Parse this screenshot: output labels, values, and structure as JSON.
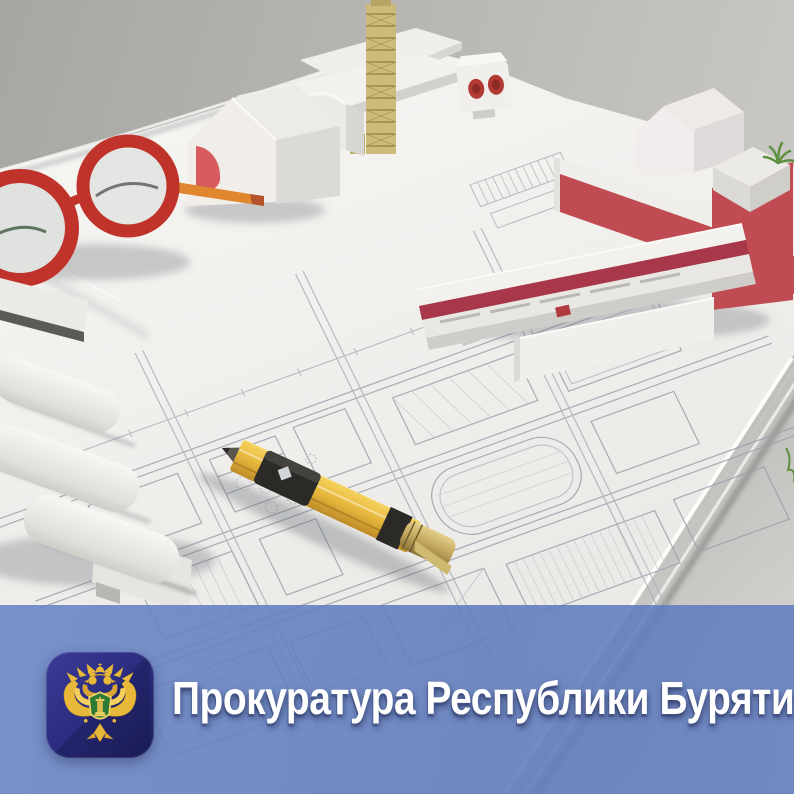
{
  "banner": {
    "title": "Прокуратура Республики Бурятия",
    "overlay_color": "#617ec0",
    "text_color": "#ffffff"
  },
  "logo": {
    "icon": "prosecutor-emblem",
    "background_color": "#2c2e82",
    "eagle_color": "#e8b83a",
    "shield_color": "#2f7a33"
  },
  "scene": {
    "description": "Architectural blueprints with white and red scale model buildings, red round eyeglasses and a yellow carpenter pencil",
    "colors": {
      "backdrop": "#b3b2af",
      "paper": "#f2f1ee",
      "model_red": "#c04b53",
      "glasses_red": "#c0332a",
      "pencil_yellow": "#e5b53c",
      "tower_gold": "#cdbc79"
    }
  }
}
